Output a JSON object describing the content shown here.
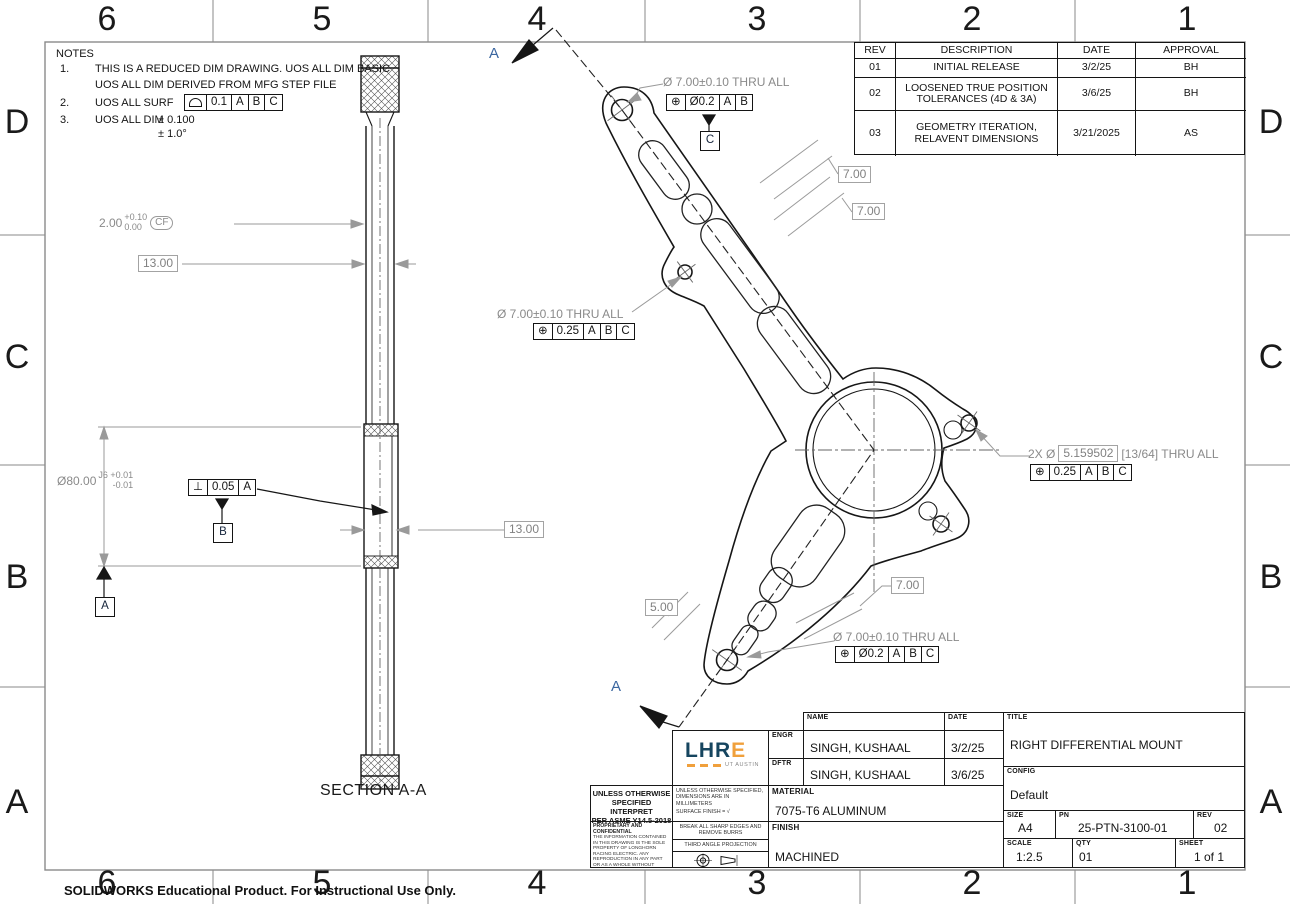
{
  "colors": {
    "dim_gray": "#8a8a8a",
    "line_black": "#161616",
    "section_blue": "#3a66a0",
    "logo_navy": "#16455f",
    "logo_orange": "#f0a03c"
  },
  "sheet": {
    "zones_top": [
      "6",
      "5",
      "4",
      "3",
      "2",
      "1"
    ],
    "zones_bottom": [
      "6",
      "5",
      "4",
      "3",
      "2",
      "1"
    ],
    "zones_left": [
      "D",
      "C",
      "B",
      "A"
    ],
    "zones_right": [
      "D",
      "C",
      "B",
      "A"
    ],
    "footer": "SOLIDWORKS Educational Product. For Instructional Use Only."
  },
  "notes": {
    "title": "NOTES",
    "n1": "1.",
    "n1a": "THIS IS A REDUCED DIM DRAWING. UOS ALL DIM BASIC",
    "n1b": "UOS ALL DIM DERIVED FROM MFG STEP FILE",
    "n2": "2.",
    "n2_text": "UOS ALL SURF",
    "n2_fcf": [
      "0.1",
      "A",
      "B",
      "C"
    ],
    "n3": "3.",
    "n3_text": "UOS ALL DIM",
    "n3_tol1": "± 0.100",
    "n3_tol2": "± 1.0°"
  },
  "rev_table": {
    "headers": [
      "REV",
      "DESCRIPTION",
      "DATE",
      "APPROVAL"
    ],
    "rows": [
      [
        "01",
        "INITIAL RELEASE",
        "3/2/25",
        "BH"
      ],
      [
        "02",
        "LOOSENED TRUE POSITION TOLERANCES (4D & 3A)",
        "3/6/25",
        "BH"
      ],
      [
        "03",
        "GEOMETRY ITERATION, RELAVENT DIMENSIONS",
        "3/21/2025",
        "AS"
      ]
    ]
  },
  "section_view": {
    "label": "SECTION A-A",
    "dim_depth": {
      "value": "2.00",
      "upper": "+0.10",
      "lower": "0.00",
      "flag": "CF"
    },
    "dim_width_top": "13.00",
    "dim_bore": {
      "value": "Ø80.00",
      "fit": "J6 +0.01",
      "fit2": "-0.01"
    },
    "fcf_perp": [
      "⊥",
      "0.05",
      "A"
    ],
    "datum_b": "B",
    "datum_a": "A",
    "dim_width_mid": "13.00"
  },
  "main_view": {
    "cut_label_top": "A",
    "cut_label_bottom": "A",
    "callout_top": {
      "text": "Ø 7.00±0.10 THRU ALL",
      "fcf": [
        "⊕",
        "Ø0.2",
        "A",
        "B"
      ],
      "datum": "C"
    },
    "callout_left": {
      "text": "Ø 7.00±0.10 THRU ALL",
      "fcf": [
        "⊕",
        "0.25",
        "A",
        "B",
        "C"
      ]
    },
    "callout_right": {
      "prefix": "2X Ø",
      "basic": "5.159502",
      "suffix": "[13/64] THRU ALL",
      "fcf": [
        "⊕",
        "0.25",
        "A",
        "B",
        "C"
      ]
    },
    "callout_bottom": {
      "text": "Ø 7.00±0.10 THRU ALL",
      "fcf": [
        "⊕",
        "Ø0.2",
        "A",
        "B",
        "C"
      ]
    },
    "dim_wall_1": "7.00",
    "dim_wall_2": "7.00",
    "dim_wall_3": "7.00",
    "dim_wall_4": "5.00"
  },
  "title_block": {
    "interpret1": "UNLESS OTHERWISE",
    "interpret2": "SPECIFIED INTERPRET",
    "interpret3": "PER ASME Y14.5-2018",
    "proprietary_title": "PROPRIETARY AND CONFIDENTIAL",
    "proprietary_body": "THE INFORMATION CONTAINED IN THIS DRAWING IS THE SOLE PROPERTY OF LONGHORN RACING ELECTRIC. ANY REPRODUCTION IN ANY PART OR AS A WHOLE WITHOUT WRITTEN PERMISSION OF LONGHORN RACING ELECTRIC IS PROHIBITED",
    "uos_dims": "UNLESS OTHERWISE SPECIFIED, DIMENSIONS ARE IN MILLIMETERS",
    "surface_finish_label": "SURFACE FINISH =",
    "surface_finish_mark": "√",
    "break_edges": "BREAK ALL SHARP EDGES AND REMOVE BURRS",
    "projection": "THIRD ANGLE PROJECTION",
    "logo_primary": "LHR",
    "logo_accent": "E",
    "logo_sub": "UT AUSTIN",
    "name_header": "NAME",
    "date_header": "DATE",
    "engr_label": "ENGR",
    "engr_name": "SINGH, KUSHAAL",
    "engr_date": "3/2/25",
    "dftr_label": "DFTR",
    "dftr_name": "SINGH, KUSHAAL",
    "dftr_date": "3/6/25",
    "material_label": "MATERIAL",
    "material": "7075-T6 ALUMINUM",
    "finish_label": "FINISH",
    "finish": "MACHINED",
    "title_label": "TITLE",
    "title": "RIGHT DIFFERENTIAL MOUNT",
    "config_label": "CONFIG",
    "config": "Default",
    "size_label": "SIZE",
    "size": "A4",
    "pn_label": "PN",
    "pn": "25-PTN-3100-01",
    "rev_label": "REV",
    "rev": "02",
    "scale_label": "SCALE",
    "scale": "1:2.5",
    "qty_label": "QTY",
    "qty": "01",
    "sheet_label": "SHEET",
    "sheet": "1 of 1"
  }
}
